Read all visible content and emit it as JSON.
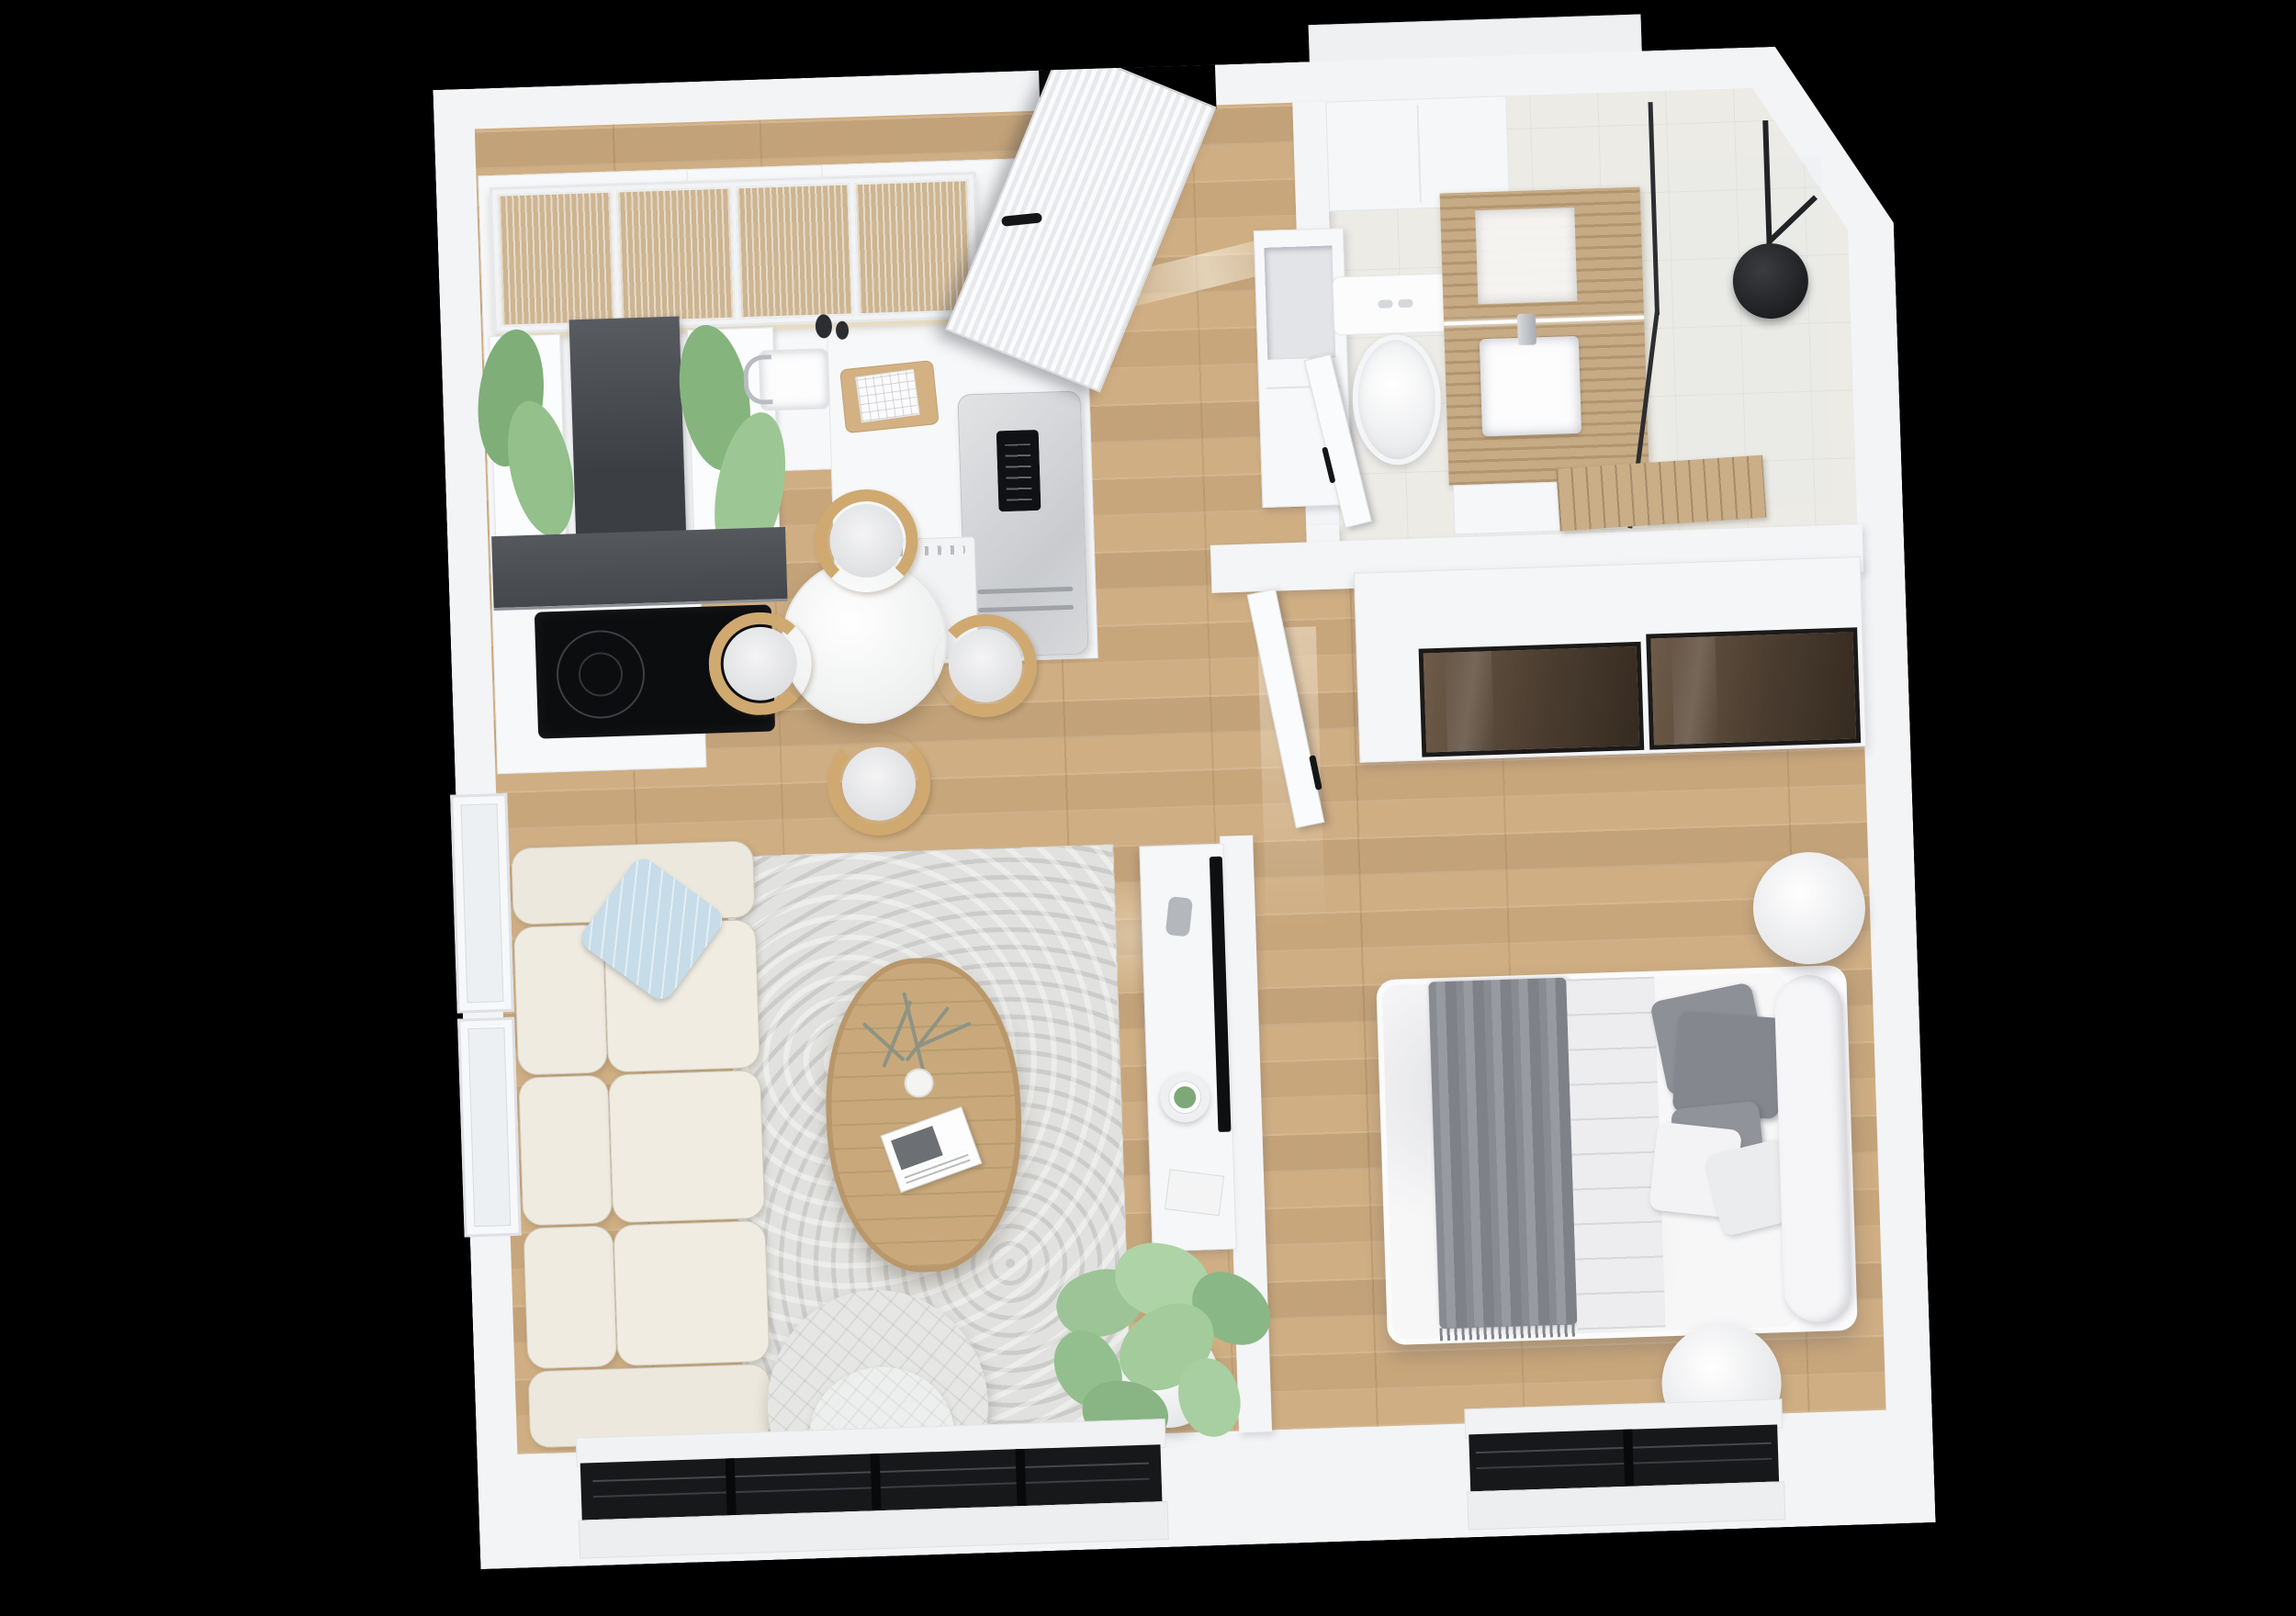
{
  "scene": {
    "title": "3D apartment floor plan render, top-down view",
    "style": "photoreal architectural visualization, one-bedroom apartment",
    "background_color": "#000000"
  },
  "palette": {
    "walls": "#f3f4f6",
    "wood_floor": "#cfae83",
    "bathroom_tile": "#ecebe6",
    "rug": "#e1e1df",
    "sofa": "#ece8dd",
    "accent_pillow": "#c6dce8",
    "throw_blanket": "#888b91",
    "wood_furniture": "#cfa96f",
    "vanity_stone": "#c6ab85",
    "wardrobe_glass": "#4b3d30",
    "black_fixtures": "#17181a",
    "plant_green": "#9cc497"
  },
  "rooms": [
    {
      "id": "living-dining-kitchen",
      "label": "Open living / dining / kitchen",
      "furniture": [
        "glass-front upper cabinets",
        "range hood",
        "induction cooktop",
        "herb planters",
        "sink",
        "cutting board",
        "dishwasher",
        "fridge-freezer",
        "round dining table",
        "four wood dining chairs",
        "boucle sofa",
        "blue accent pillow",
        "area rug",
        "oval wood coffee table",
        "dried plant and magazine",
        "quilted armchair",
        "tv sideboard",
        "wall tv",
        "decor bowl with succulent",
        "fiddle-leaf fig plant"
      ]
    },
    {
      "id": "entry-hall",
      "label": "Entry hall",
      "furniture": [
        "fluted front door",
        "open storage niche"
      ]
    },
    {
      "id": "bathroom",
      "label": "Bathroom",
      "furniture": [
        "wall-hung toilet",
        "stone vanity with vessel sink",
        "mirror",
        "walk-in glass shower",
        "black rain shower head",
        "wood slat mat",
        "bathroom door"
      ]
    },
    {
      "id": "bedroom",
      "label": "Bedroom",
      "furniture": [
        "double bed",
        "grey throw",
        "grey and white pillows",
        "bolster cushion",
        "sliding-door wardrobe with bronze glass",
        "two round nightstands",
        "bedroom door"
      ]
    }
  ],
  "openings": {
    "front_door": "top wall, open inward",
    "left_wall_windows": 2,
    "living_bottom_window_mullions": 3,
    "bedroom_bottom_window_mullions": 1,
    "top_right_corner": "chamfered exterior wall"
  }
}
